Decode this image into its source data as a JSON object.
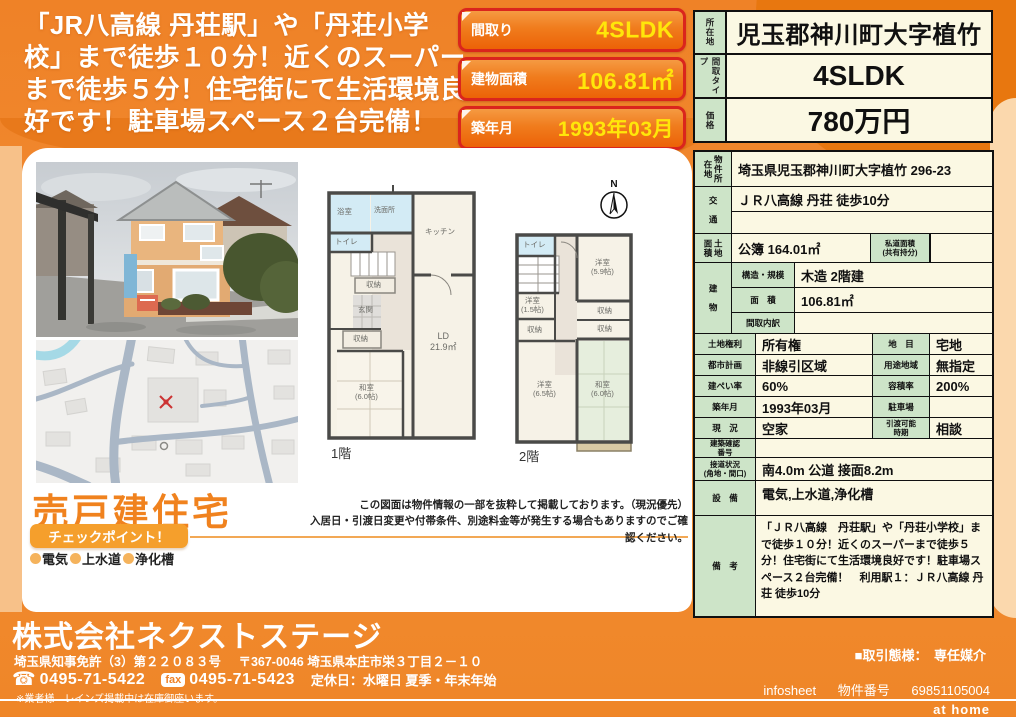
{
  "headline": "「JR八高線 丹荘駅」や「丹荘小学校」まで徒歩１０分！近くのスーパーまで徒歩５分！住宅街にて生活環境良好です！駐車場スペース２台完備！",
  "spec_boxes": [
    {
      "label": "間取り",
      "value": "4SLDK"
    },
    {
      "label": "建物面積",
      "value": "106.81㎡"
    },
    {
      "label": "築年月",
      "value": "1993年03月"
    }
  ],
  "price_table": {
    "rows": [
      {
        "label": "所在地",
        "value": "児玉郡神川町大字植竹"
      },
      {
        "label": "間取タイプ",
        "value": "4SLDK"
      },
      {
        "label": "価格",
        "value": "780万円"
      }
    ]
  },
  "detail_table": {
    "location": {
      "label": "物件所在地",
      "value": "埼玉県児玉郡神川町大字植竹 296-23"
    },
    "access": {
      "label": "交　通",
      "value": "ＪＲ八高線 丹荘 徒歩10分",
      "value2": ""
    },
    "land": {
      "label": "土地面積",
      "value": "公簿 164.01㎡",
      "label2": "私道面積\n(共有持分)",
      "value2": ""
    },
    "building": {
      "label": "建　物",
      "structure_label": "構造・規模",
      "structure": "木造 2階建",
      "area_label": "面　積",
      "area": "106.81㎡",
      "layout_label": "間取内訳",
      "layout": ""
    },
    "pairs": [
      {
        "l1": "土地権利",
        "v1": "所有権",
        "l2": "地　目",
        "v2": "宅地"
      },
      {
        "l1": "都市計画",
        "v1": "非線引区域",
        "l2": "用途地域",
        "v2": "無指定"
      },
      {
        "l1": "建ぺい率",
        "v1": "60%",
        "l2": "容積率",
        "v2": "200%"
      },
      {
        "l1": "築年月",
        "v1": "1993年03月",
        "l2": "駐車場",
        "v2": ""
      },
      {
        "l1": "現　況",
        "v1": "空家",
        "l2": "引渡可能\n時期",
        "v2": "相談"
      }
    ],
    "kakunin": {
      "label": "建築確認\n番号",
      "value": ""
    },
    "setsudo": {
      "label": "接道状況\n(角地・間口)",
      "value": "南4.0m 公道 接面8.2m"
    },
    "setsubi": {
      "label": "設　備",
      "value": "電気,上水道,浄化槽"
    },
    "biko": {
      "label": "備　考",
      "value": "「ＪＲ八高線　丹荘駅」や「丹荘小学校」まで徒歩１０分！近くのスーパーまで徒歩５分！住宅街にて生活環境良好です！駐車場スペース２台完備！　利用駅１：ＪＲ八高線 丹荘 徒歩10分"
    }
  },
  "floorplan1": {
    "title": "1階",
    "rooms": {
      "bath": "浴室",
      "wash": "洗面所",
      "toilet": "トイレ",
      "kitchen": "キッチン",
      "closet1": "収納",
      "entrance": "玄関",
      "closet2": "収納",
      "washitsu": "和室\n(6.0帖)",
      "ld": "LD\n21.9㎡"
    }
  },
  "floorplan2": {
    "title": "2階",
    "compass": "N",
    "rooms": {
      "toilet": "トイレ",
      "yoshitsu59": "洋室\n(5.9帖)",
      "yoshitsu15": "洋室\n(1.5帖)",
      "closet_r1": "収納",
      "closet_r2": "収納",
      "closet_l": "収納",
      "yoshitsu65": "洋室\n(6.5帖)",
      "washitsu": "和室\n(6.0帖)"
    }
  },
  "left_bottom": {
    "sale_type": "売戸建住宅",
    "checkpoint": "チェックポイント！",
    "features": [
      "電気",
      "上水道",
      "浄化槽"
    ]
  },
  "disclaimer": {
    "line1": "この図面は物件情報の一部を抜粋して掲載しております。（現況優先）",
    "line2": "入居日・引渡日変更や付帯条件、別途料金等が発生する場合もありますのでご確認ください。"
  },
  "footer": {
    "company": "株式会社ネクストステージ",
    "license": "埼玉県知事免許（3）第２２０８３号",
    "address": "〒367-0046 埼玉県本庄市栄３丁目２－１０",
    "tel_icon": "☎",
    "tel": "0495-71-5422",
    "fax_label": "fax",
    "fax": "0495-71-5423",
    "holiday": "定休日：水曜日 夏季・年末年始",
    "agent_note": "※業者様　レインズ掲載中は在庫御座います。",
    "deal": "■取引態様：　専任媒介",
    "infosheet": "infosheet",
    "bukken_label": "物件番号",
    "bukken_no": "69851105004",
    "athome": "at home"
  },
  "colors": {
    "accent_orange": "#f0862a",
    "box_red": "#da251d",
    "value_yellow": "#ffe60a",
    "cell_green": "#cde4c8",
    "cell_cream": "#fbf8e3"
  }
}
